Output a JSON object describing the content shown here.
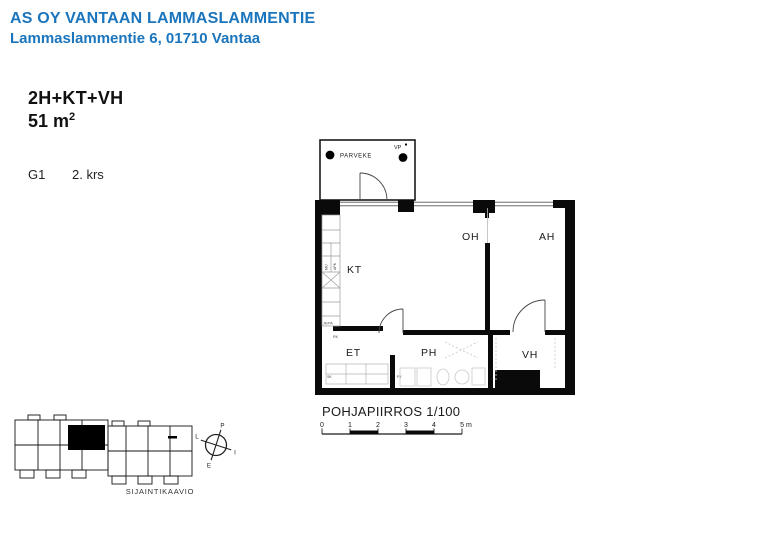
{
  "header": {
    "title": "AS OY VANTAAN LAMMASLAMMENTIE",
    "address": "Lammaslammentie 6, 01710 Vantaa",
    "accent_color": "#1b75bc"
  },
  "apartment": {
    "layout": "2H+KT+VH",
    "area": "51 m",
    "area_sup": "2",
    "unit": "G1",
    "floor": "2. krs"
  },
  "floorplan": {
    "caption": "POHJAPIIRROS 1/100",
    "balcony": {
      "label": "PARVEKE",
      "vp_label": "VP"
    },
    "rooms": {
      "kt": "KT",
      "oh": "OH",
      "ah": "AH",
      "et": "ET",
      "ph": "PH",
      "vh": "VH"
    },
    "appliances": {
      "mu": "MU",
      "apk": "APK",
      "jkpa": "JK/PA",
      "rk": "RK",
      "sk": "SK",
      "py": "PY"
    },
    "scale_bar": {
      "ticks": [
        "0",
        "1",
        "2",
        "3",
        "4",
        "5 m"
      ]
    }
  },
  "siteplan": {
    "caption": "SIJAINTIKAAVIO",
    "compass": {
      "north": "P",
      "east": "I",
      "south": "E",
      "west": "L"
    }
  }
}
